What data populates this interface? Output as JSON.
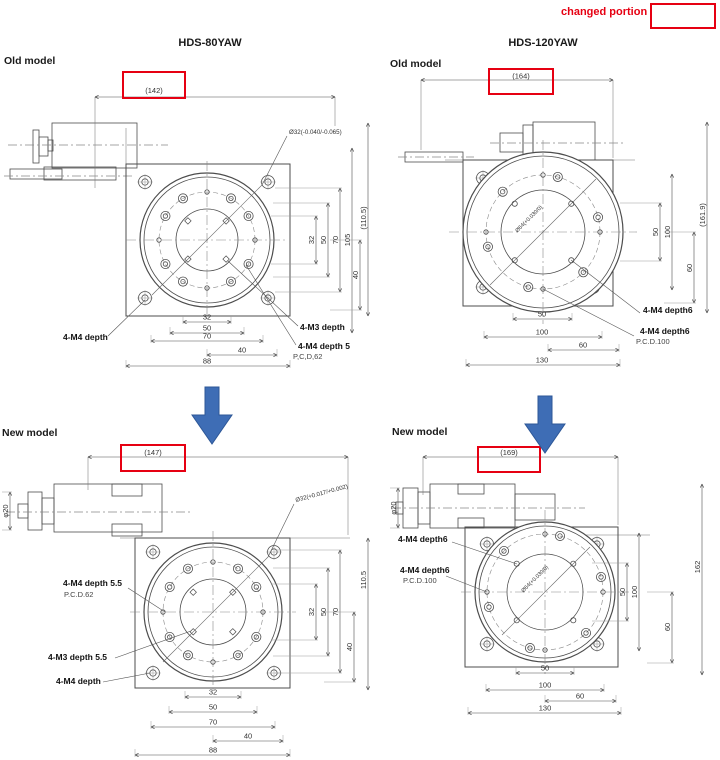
{
  "legend": {
    "changed_portion": "changed portion"
  },
  "colors": {
    "highlight_red": "#e60012",
    "arrow_blue": "#3e6db5"
  },
  "columns": {
    "hds80": {
      "title": "HDS-80YAW",
      "old": {
        "label": "Old model",
        "highlight": "(142)",
        "bore": "Ø32(-0.040/-0.065)",
        "dims": {
          "d32": "32",
          "d50": "50",
          "d70": "70",
          "d105": "105",
          "d40": "40",
          "height": "(110.5)",
          "b32": "32",
          "b50": "50",
          "b70": "70",
          "b40": "40",
          "width": "88"
        },
        "callouts": {
          "c1": "4-M4 depth",
          "c2": "4-M3 depth",
          "c3": "4-M4 depth 5",
          "pcd": "P,C,D,62"
        }
      },
      "new": {
        "label": "New model",
        "highlight": "(147)",
        "motor_dia": "φ20",
        "bore": "Ø32(+0.017/+0.002)",
        "dims": {
          "d32": "32",
          "d50": "50",
          "d70": "70",
          "d40": "40",
          "height": "110.5",
          "b32": "32",
          "b50": "50",
          "b70": "70",
          "b40": "40",
          "width": "88"
        },
        "callouts": {
          "c1": "4-M4 depth 5.5",
          "pcd": "P.C.D.62",
          "c2": "4-M3 depth 5.5",
          "c3": "4-M4 depth"
        }
      }
    },
    "hds120": {
      "title": "HDS-120YAW",
      "old": {
        "label": "Old model",
        "highlight": "(164)",
        "bore": "Ø64(+0.030/0)",
        "dims": {
          "d50": "50",
          "d100": "100",
          "d60": "60",
          "height": "(161.9)",
          "b50": "50",
          "b100": "100",
          "b60": "60",
          "width": "130"
        },
        "callouts": {
          "c1": "4-M4 depth6",
          "c2": "4-M4 depth6",
          "pcd": "P.C.D.100"
        }
      },
      "new": {
        "label": "New model",
        "highlight": "(169)",
        "motor_dia": "φ20",
        "bore": "Ø64(+0.030/0)",
        "dims": {
          "d50": "50",
          "d100": "100",
          "d60": "60",
          "height": "162",
          "b50": "50",
          "b100": "100",
          "b60": "60",
          "width": "130"
        },
        "callouts": {
          "c1": "4-M4 depth6",
          "c2": "4-M4 depth6",
          "pcd": "P.C.D.100"
        }
      }
    }
  }
}
